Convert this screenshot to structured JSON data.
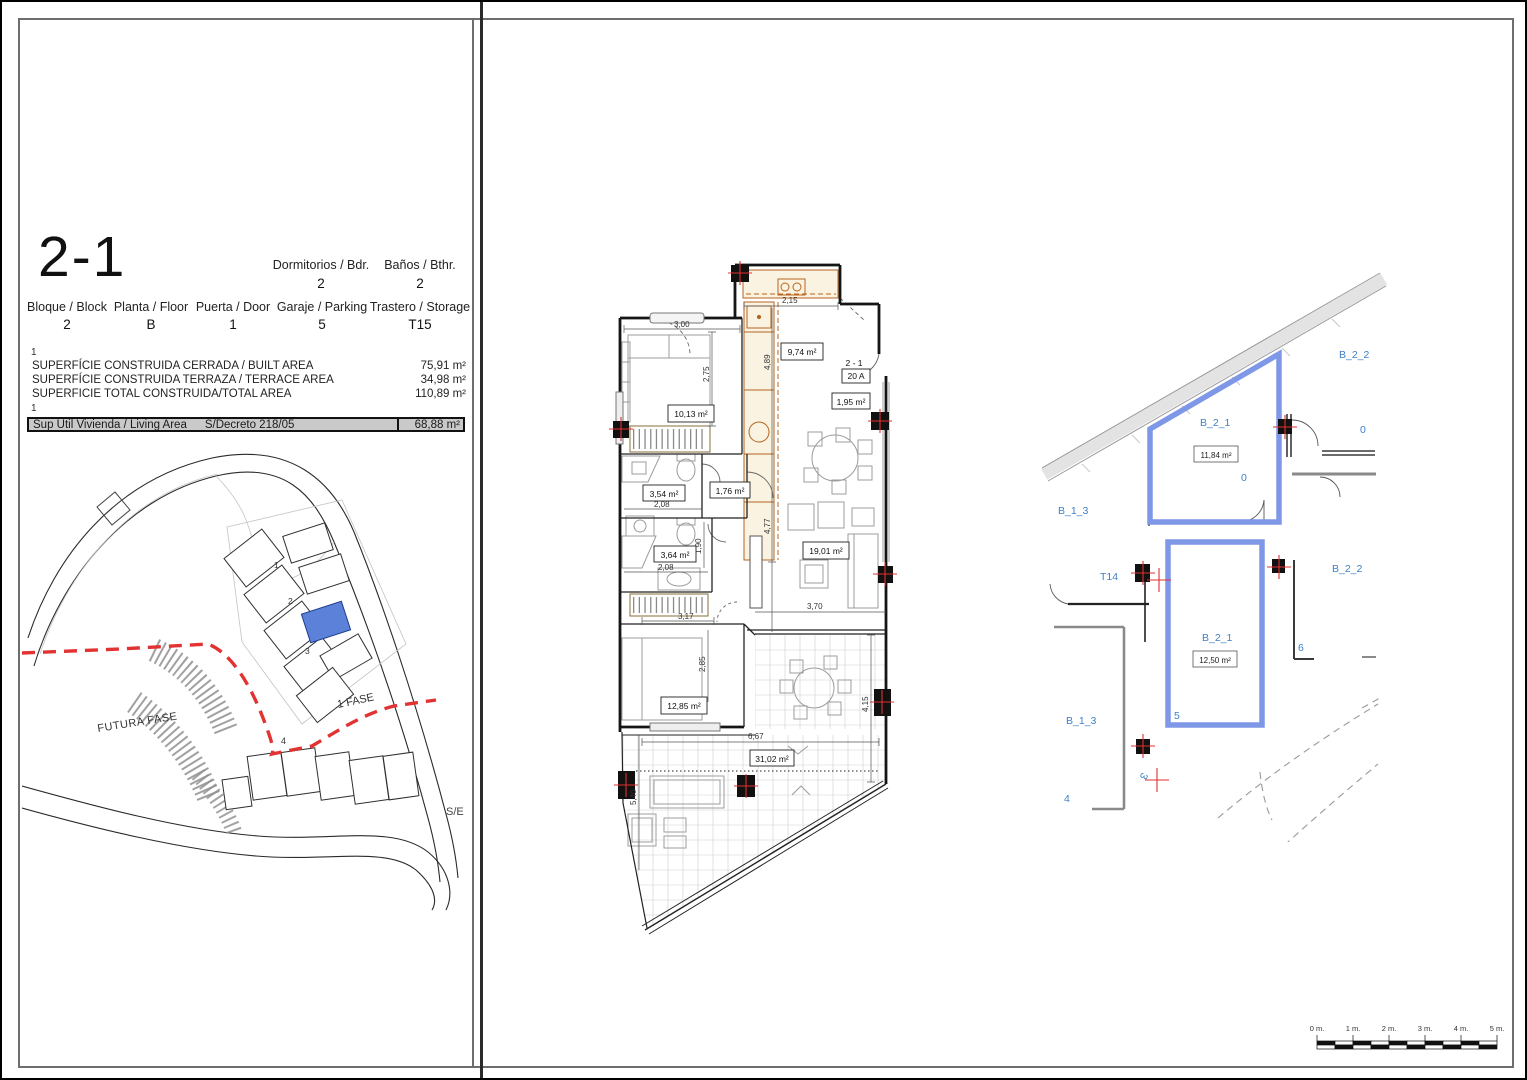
{
  "title": {
    "unit_code": "2-1"
  },
  "header": {
    "row1": [
      {
        "label": "Dormitorios / Bdr.",
        "value": "2"
      },
      {
        "label": "Baños / Bthr.",
        "value": "2"
      }
    ],
    "row2": [
      {
        "label": "Bloque / Block",
        "value": "2"
      },
      {
        "label": "Planta / Floor",
        "value": "B"
      },
      {
        "label": "Puerta / Door",
        "value": "1"
      },
      {
        "label": "Garaje / Parking",
        "value": "5"
      },
      {
        "label": "Trastero / Storage",
        "value": "T15"
      }
    ]
  },
  "areas": {
    "note1": "1",
    "rows": [
      {
        "label": "SUPERFÍCIE CONSTRUIDA CERRADA / BUILT AREA",
        "value": "75,91 m²"
      },
      {
        "label": "SUPERFÍCIE CONSTRUIDA TERRAZA / TERRACE AREA",
        "value": "34,98 m²"
      },
      {
        "label": "SUPERFICIE TOTAL CONSTRUIDA/TOTAL AREA",
        "value": "110,89 m²"
      }
    ],
    "note2": "1",
    "living": {
      "label": "Sup Util Vivienda / Living Area",
      "decree": "S/Decreto 218/05",
      "value": "68,88 m²"
    }
  },
  "site_plan": {
    "futura_fase": "FUTURA FASE",
    "fase_1": "1 FASE",
    "scale_note": "S/E",
    "block1": "1",
    "block2": "2",
    "block3": "3",
    "block4": "4"
  },
  "floor_plan": {
    "unit_ref": "2 - 1",
    "door_ref": "20 A",
    "rooms": {
      "bedroom1": "10,13 m²",
      "kitchen": "9,74 m²",
      "entry": "1,95 m²",
      "bath1": "3,54 m²",
      "hall": "1,76 m²",
      "bath2": "3,64 m²",
      "living": "19,01 m²",
      "bedroom2": "12,85 m²",
      "terrace": "31,02 m²"
    },
    "dims": {
      "d300": "3,00",
      "d275": "2,75",
      "d215": "2,15",
      "d489": "4,89",
      "d477": "4,77",
      "d370": "3,70",
      "d208a": "2,08",
      "d208b": "2,08",
      "d190": "1,90",
      "d285": "2,85",
      "d317": "3,17",
      "d667": "6,67",
      "d415": "4,15",
      "d540": "5,40"
    }
  },
  "garage_plan": {
    "storage": {
      "name": "B_2_1",
      "area": "11,84 m²"
    },
    "parking": {
      "name": "B_2_1",
      "area": "12,50 m²"
    },
    "labels": {
      "b22_top": "B_2_2",
      "b22_mid": "B_2_2",
      "b13_left": "B_1_3",
      "b13_lower": "B_1_3",
      "t14": "T14",
      "zero_a": "0",
      "zero_b": "0",
      "n3": "3",
      "n4": "4",
      "n5": "5",
      "n6": "6"
    }
  },
  "scale_bar": {
    "ticks": [
      "0 m.",
      "1 m.",
      "2 m.",
      "3 m.",
      "4 m.",
      "5 m."
    ]
  }
}
